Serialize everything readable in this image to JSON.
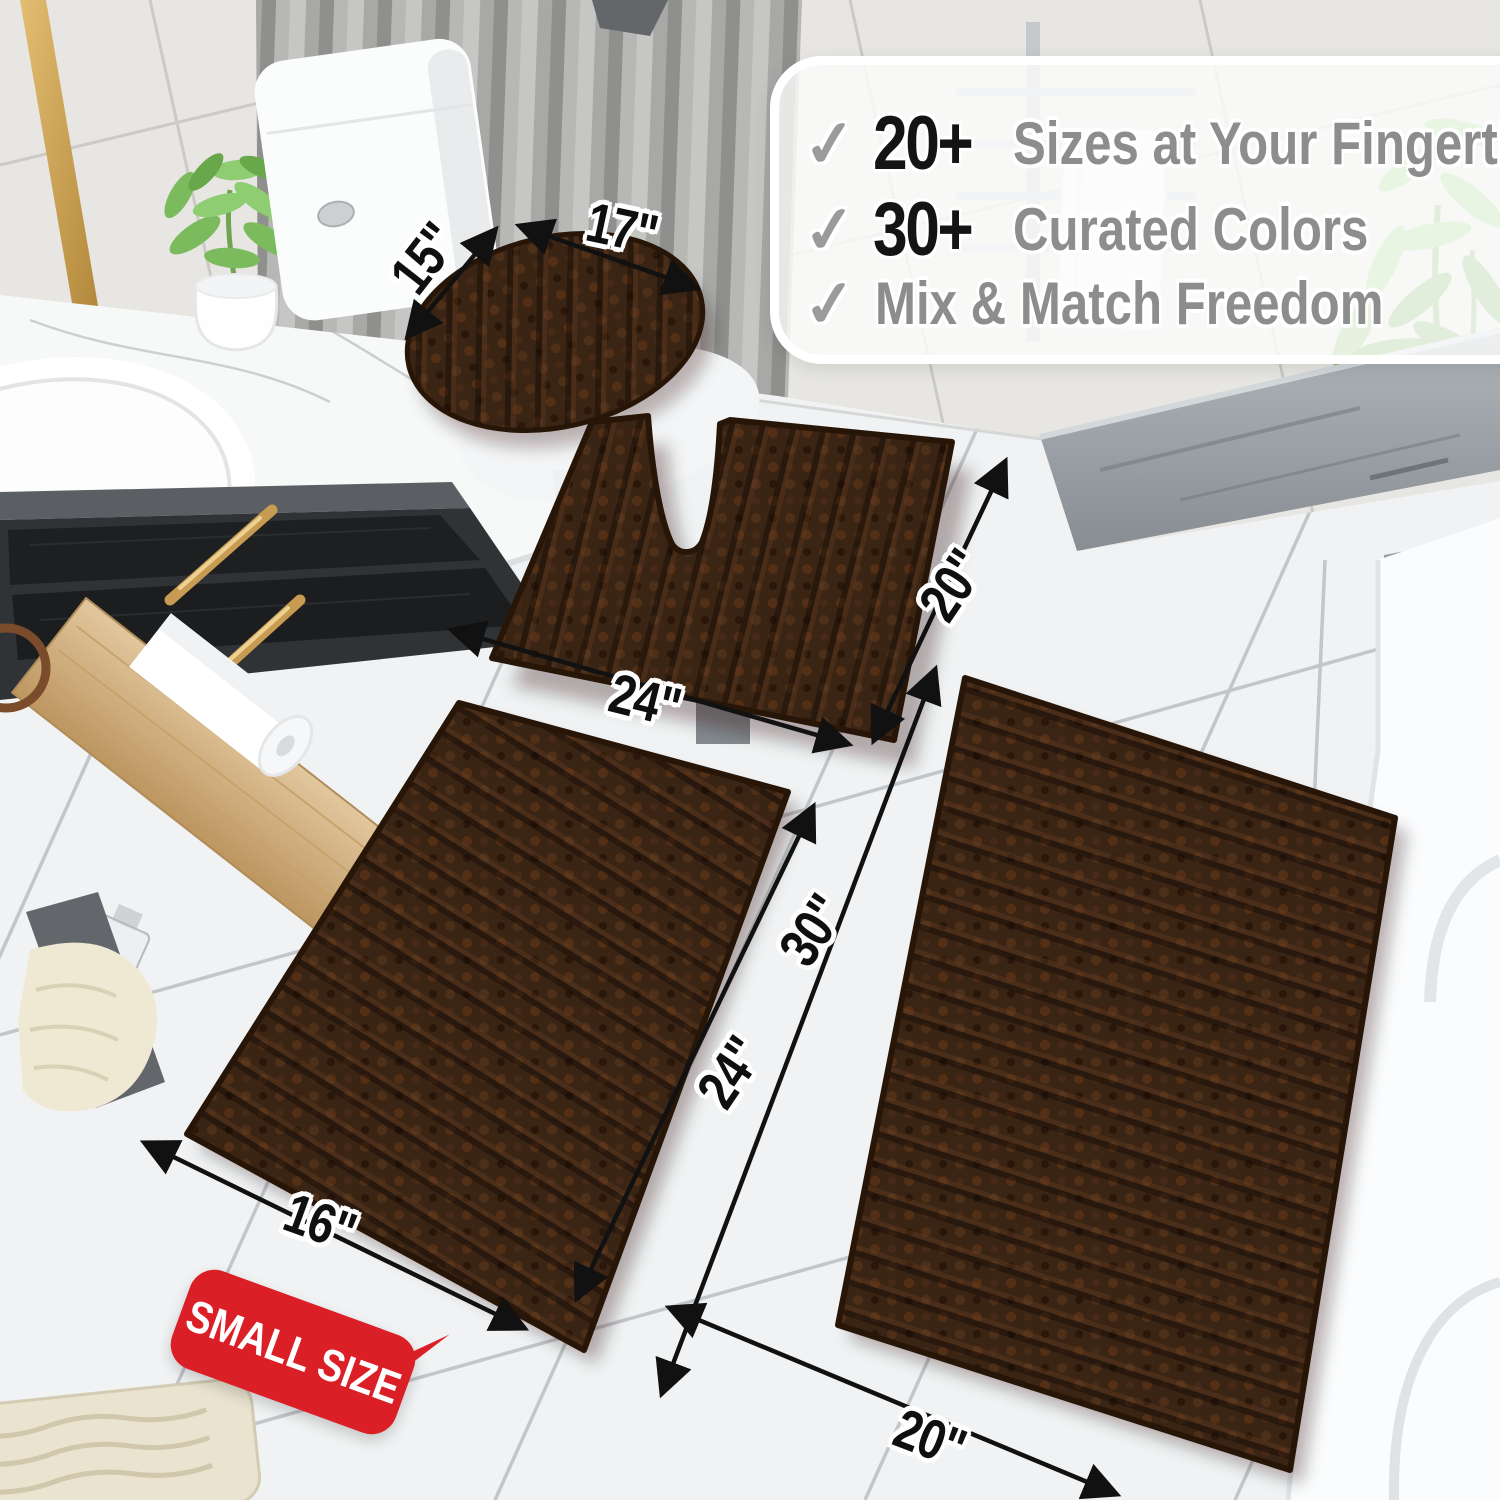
{
  "callout": {
    "check_glyph": "✓",
    "items": [
      {
        "icon": "checkmark-icon",
        "number": "20+",
        "label": "Sizes at Your Fingertips"
      },
      {
        "icon": "checkmark-icon",
        "number": "30+",
        "label": "Curated Colors"
      },
      {
        "icon": "checkmark-icon",
        "number": "",
        "label": "Mix & Match Freedom"
      }
    ]
  },
  "dimensions": {
    "lid_width": "15\"",
    "lid_length": "17\"",
    "contour_rug_width": "24\"",
    "contour_rug_depth": "20\"",
    "small_rug_width": "16\"",
    "small_rug_length": "24\"",
    "large_rug_length": "30\"",
    "large_rug_width": "20\""
  },
  "badge": {
    "label": "SMALL SIZE"
  },
  "vanity": {
    "bottle_label": "MISQ"
  },
  "colors": {
    "rug_brown": "#3A2414",
    "badge_red": "#DB1F26",
    "number_black": "#141414",
    "text_gray": "#8D8D8D",
    "check_gray": "#9B9B9B",
    "brass_gold": "#C89B52",
    "wood": "#D8BA8C"
  }
}
